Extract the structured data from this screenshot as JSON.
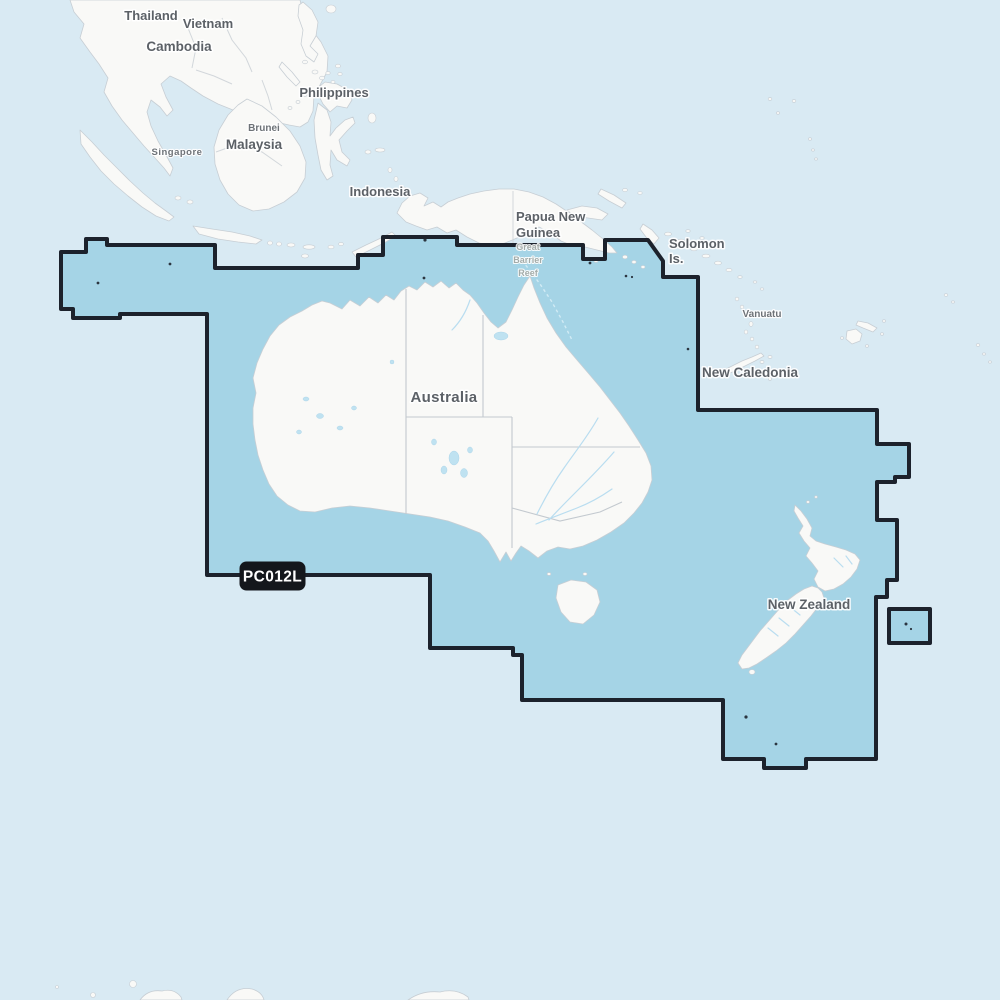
{
  "region": {
    "code": "PC012L",
    "description_labels": {
      "australia": "Australia",
      "new_zealand": "New Zealand"
    }
  },
  "labels": {
    "thailand": "Thailand",
    "vietnam": "Vietnam",
    "cambodia": "Cambodia",
    "philippines": "Philippines",
    "brunei": "Brunei",
    "malaysia": "Malaysia",
    "singapore": "Singapore",
    "indonesia": "Indonesia",
    "papua_line1": "Papua New",
    "papua_line2": "Guinea",
    "solomon_line1": "Solomon",
    "solomon_line2": "Is.",
    "vanuatu": "Vanuatu",
    "new_caledonia": "New Caledonia",
    "australia": "Australia",
    "new_zealand": "New Zealand",
    "gbr_line1": "Great",
    "gbr_line2": "Barrier",
    "gbr_line3": "Reef"
  },
  "colors": {
    "ocean": "#d9eaf3",
    "coverage_fill": "#a5d4e6",
    "coverage_border": "#1c222c",
    "land": "#f9f9f7",
    "land_outline": "#c7ced4",
    "state_border": "#c3c9cf",
    "water_feature": "#bfe2f1",
    "label_text": "#5c6167",
    "minor_label_text": "#6d7277",
    "reef_label_text": "#a4aca9",
    "badge_bg": "#14171c",
    "badge_text": "#ffffff"
  }
}
